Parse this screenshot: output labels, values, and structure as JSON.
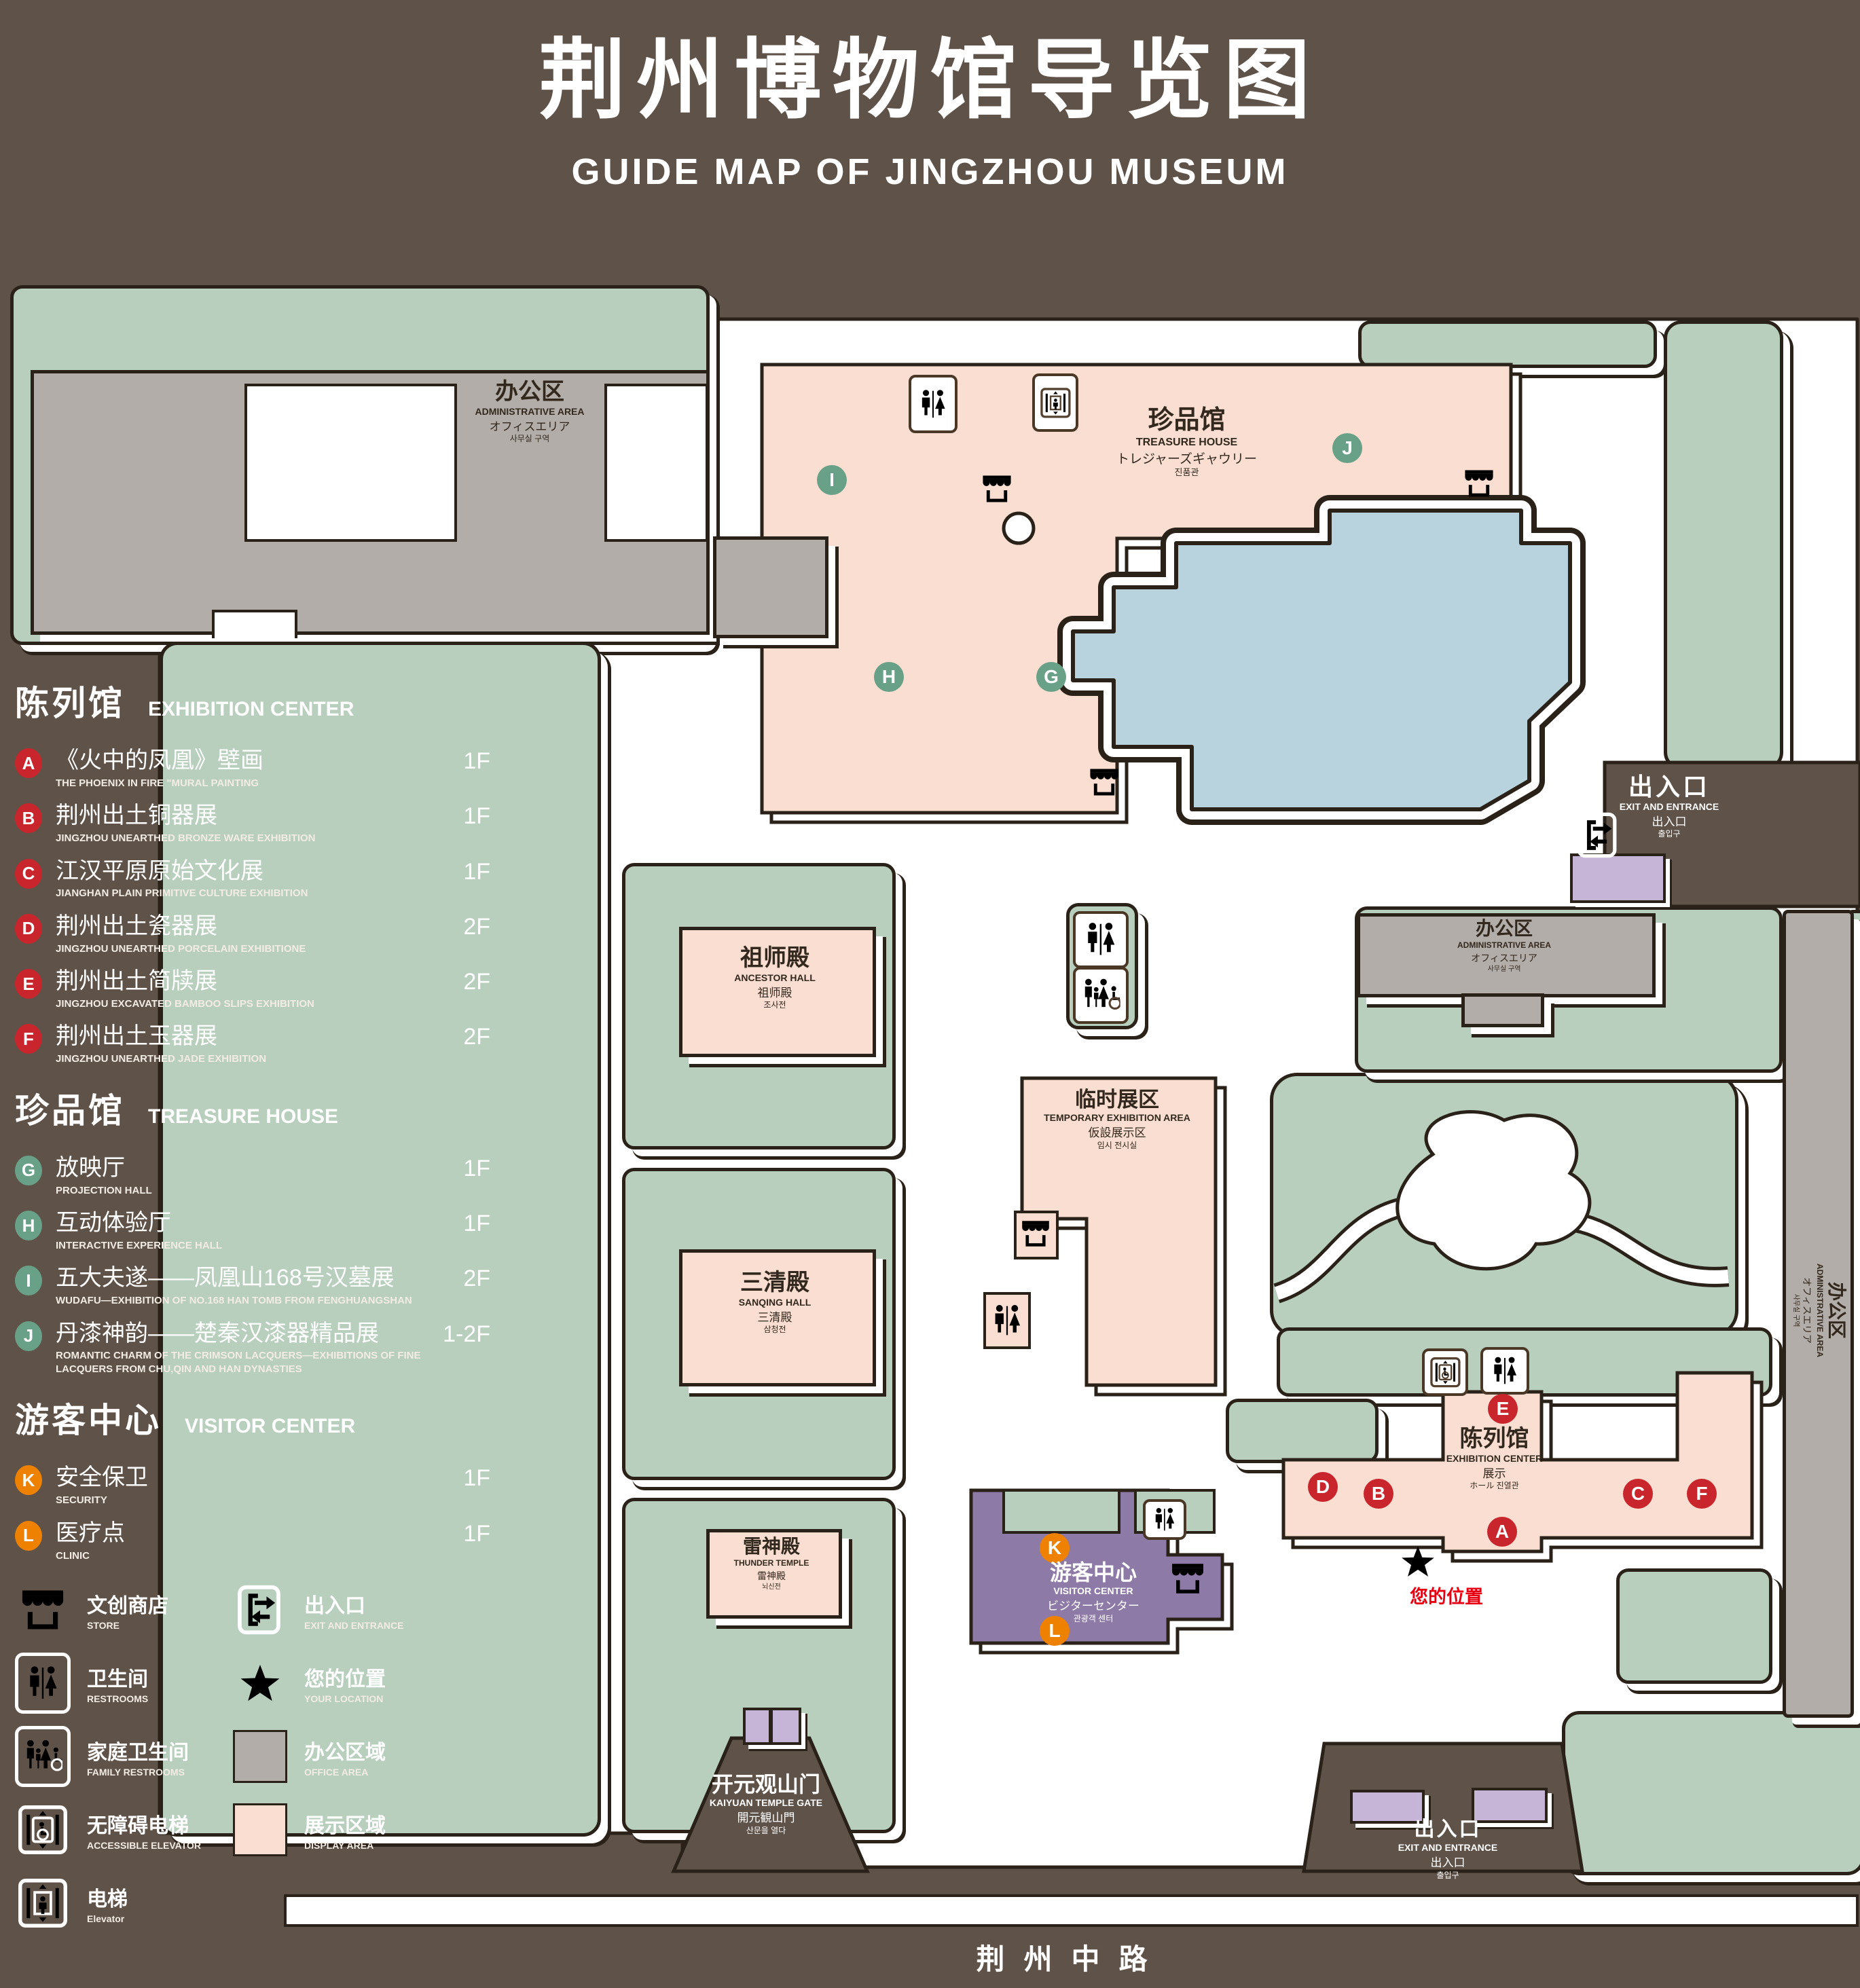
{
  "title": {
    "zh": "荆州博物馆导览图",
    "en": "GUIDE MAP OF JINGZHOU MUSEUM"
  },
  "colors": {
    "background": "#5f5248",
    "lawn_green": "#b8cfbe",
    "office_gray": "#b2ada9",
    "display_pink": "#f9ded1",
    "visitor_purple": "#8e7aa6",
    "gate_purple": "#c6b5d6",
    "pond_blue": "#b8d3de",
    "badge_red": "#c9252c",
    "badge_green": "#69a188",
    "badge_orange": "#ee8100",
    "marker_red": "#e60012",
    "outline": "#2a2118"
  },
  "sidebar": {
    "sections": [
      {
        "zh": "陈列馆",
        "en": "EXHIBITION CENTER",
        "items": [
          {
            "key": "A",
            "zh": "《火中的凤凰》壁画",
            "en": "THE PHOENIX IN FIRE \"MURAL PAINTING",
            "floor": "1F"
          },
          {
            "key": "B",
            "zh": "荆州出土铜器展",
            "en": "JINGZHOU UNEARTHED BRONZE WARE EXHIBITION",
            "floor": "1F"
          },
          {
            "key": "C",
            "zh": "江汉平原原始文化展",
            "en": "JIANGHAN PLAIN PRIMITIVE CULTURE EXHIBITION",
            "floor": "1F"
          },
          {
            "key": "D",
            "zh": "荆州出土瓷器展",
            "en": "JINGZHOU UNEARTHED PORCELAIN EXHIBITIONE",
            "floor": "2F"
          },
          {
            "key": "E",
            "zh": "荆州出土简牍展",
            "en": "JINGZHOU EXCAVATED BAMBOO SLIPS EXHIBITION",
            "floor": "2F"
          },
          {
            "key": "F",
            "zh": "荆州出土玉器展",
            "en": "JINGZHOU UNEARTHED JADE EXHIBITION",
            "floor": "2F"
          }
        ]
      },
      {
        "zh": "珍品馆",
        "en": "TREASURE HOUSE",
        "items": [
          {
            "key": "G",
            "zh": "放映厅",
            "en": "PROJECTION HALL",
            "floor": "1F"
          },
          {
            "key": "H",
            "zh": "互动体验厅",
            "en": "INTERACTIVE EXPERIENCE HALL",
            "floor": "1F"
          },
          {
            "key": "I",
            "zh": "五大夫遂——凤凰山168号汉墓展",
            "en": "WUDAFU—EXHIBITION OF NO.168 HAN TOMB FROM FENGHUANGSHAN",
            "floor": "2F"
          },
          {
            "key": "J",
            "zh": "丹漆神韵——楚秦汉漆器精品展",
            "en": "ROMANTIC CHARM OF THE CRIMSON LACQUERS—EXHIBITIONS OF FINE LACQUERS FROM CHU,QIN AND HAN DYNASTIES",
            "floor": "1-2F"
          }
        ]
      },
      {
        "zh": "游客中心",
        "en": "VISITOR CENTER",
        "items": [
          {
            "key": "K",
            "zh": "安全保卫",
            "en": "SECURITY",
            "floor": "1F"
          },
          {
            "key": "L",
            "zh": "医疗点",
            "en": "CLINIC",
            "floor": "1F"
          }
        ]
      }
    ],
    "legend": [
      {
        "icon": "store-icon",
        "zh": "文创商店",
        "en": "STORE"
      },
      {
        "icon": "exit-icon",
        "zh": "出入口",
        "en": "EXIT AND ENTRANCE"
      },
      {
        "icon": "restrooms-icon",
        "zh": "卫生间",
        "en": "RESTROOMS"
      },
      {
        "icon": "location-star-icon",
        "zh": "您的位置",
        "en": "YOUR LOCATION"
      },
      {
        "icon": "family-restrooms-icon",
        "zh": "家庭卫生间",
        "en": "FAMILY RESTROOMS"
      },
      {
        "icon": "office-area-swatch",
        "zh": "办公区域",
        "en": "OFFICE AREA"
      },
      {
        "icon": "accessible-elevator-icon",
        "zh": "无障碍电梯",
        "en": "ACCESSIBLE ELEVATOR"
      },
      {
        "icon": "display-area-swatch",
        "zh": "展示区域",
        "en": "DISPLAY AREA"
      },
      {
        "icon": "elevator-icon",
        "zh": "电梯",
        "en": "Elevator"
      }
    ]
  },
  "map": {
    "admin": {
      "l1": "办公区",
      "l2": "ADMINISTRATIVE AREA",
      "l3": "オフィスエリア",
      "l4": "사무실 구역"
    },
    "treasure": {
      "l1": "珍品馆",
      "l2": "TREASURE HOUSE",
      "l3": "トレジャーズギャウリー",
      "l4": "진품관"
    },
    "ancestor": {
      "l1": "祖师殿",
      "l2": "ANCESTOR HALL",
      "l3": "祖师殿",
      "l4": "조사전"
    },
    "temporary": {
      "l1": "临时展区",
      "l2": "TEMPORARY EXHIBITION AREA",
      "l3": "仮設展示区",
      "l4": "임시 전시실"
    },
    "sanqing": {
      "l1": "三清殿",
      "l2": "SANQING HALL",
      "l3": "三清殿",
      "l4": "삼청전"
    },
    "thunder": {
      "l1": "雷神殿",
      "l2": "THUNDER TEMPLE",
      "l3": "雷神殿",
      "l4": "뇌신전"
    },
    "exhibition": {
      "l1": "陈列馆",
      "l2": "EXHIBITION CENTER",
      "l3": "展示",
      "l4": "ホール 진열관"
    },
    "visitor": {
      "l1": "游客中心",
      "l2": "VISITOR CENTER",
      "l3": "ビジターセンター",
      "l4": "관광객 센터"
    },
    "gate": {
      "l1": "开元观山门",
      "l2": "KAIYUAN TEMPLE GATE",
      "l3": "開元観山門",
      "l4": "산문을 열다"
    },
    "exit": {
      "l1": "出入口",
      "l2": "EXIT AND ENTRANCE",
      "l3": "出入口",
      "l4": "출입구"
    },
    "road": "荆州中路",
    "your_location": "您的位置",
    "markers": {
      "a": "A",
      "b": "B",
      "c": "C",
      "d": "D",
      "e": "E",
      "f": "F",
      "g": "G",
      "h": "H",
      "i": "I",
      "j": "J",
      "k": "K",
      "l": "L"
    }
  }
}
